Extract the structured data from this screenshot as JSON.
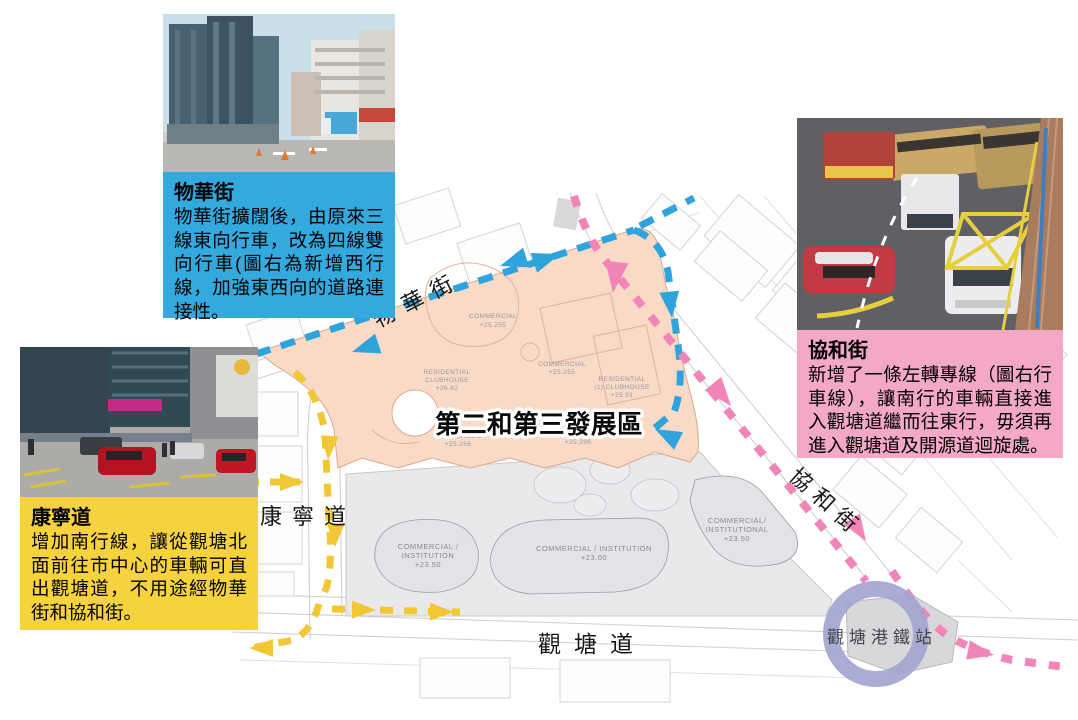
{
  "callouts": {
    "mut_wah_street": {
      "title": "物華街",
      "body": "物華街擴闊後，由原來三線東向行車，改為四線雙向行車(圖右為新增西行線，加強東西向的道路連接性。",
      "bg_color": "#33A9DE"
    },
    "hip_wo_street": {
      "title": "協和街",
      "body": "新增了一條左轉專線（圖右行車線），讓南行的車輛直接進入觀塘道繼而往東行，毋須再進入觀塘道及開源道迴旋處。",
      "bg_color": "#F3A9C6"
    },
    "hong_ning_road": {
      "title": "康寧道",
      "body": "增加南行線，讓從觀塘北面前往市中心的車輛可直出觀塘道，不用途經物華街和協和街。",
      "bg_color": "#F6D23F"
    }
  },
  "map": {
    "development_area_label": "第二和第三發展區",
    "street_labels": {
      "mut_wah": "物華街",
      "hong_ning": "康寧道",
      "kwun_tong_road": "觀塘道",
      "hip_wo": "協和街"
    },
    "mtr_station_label": "觀塘港鐵站",
    "site_plan_labels": {
      "commercial_a_1": "COMMERCIAL",
      "commercial_a_2": "+25.255",
      "commercial_b_1": "COMMERCIAL",
      "commercial_b_2": "+25.255",
      "residential_a_1": "RESIDENTIAL",
      "residential_a_2": "CLUBHOUSE",
      "residential_a_3": "+26.62",
      "residential_b_1": "RESIDENTIAL",
      "residential_b_2": "(1) CLUBHOUSE",
      "residential_b_3": "+25.91",
      "commercial_c_1": "COMMERCIAL",
      "commercial_c_2": "+25.256",
      "commercial_d_1": "+25.396",
      "institution_a_1": "COMMERCIAL /",
      "institution_a_2": "INSTITUTION",
      "institution_a_3": "+23.50",
      "institution_b_1": "COMMERCIAL / INSTITUTION",
      "institution_b_2": "+23.00",
      "institution_c_1": "COMMERCIAL/",
      "institution_c_2": "INSTITUTIONAL",
      "institution_c_3": "+23.50"
    },
    "colors": {
      "development_area_fill": "#F9DAC6",
      "development_area_stroke": "#DCA78C",
      "lower_area_fill": "#E9E9EC",
      "route_blue": "#2FA3DC",
      "route_pink": "#F285B8",
      "route_yellow": "#F2C735",
      "mtr_ring": "#A2A5CF"
    }
  }
}
